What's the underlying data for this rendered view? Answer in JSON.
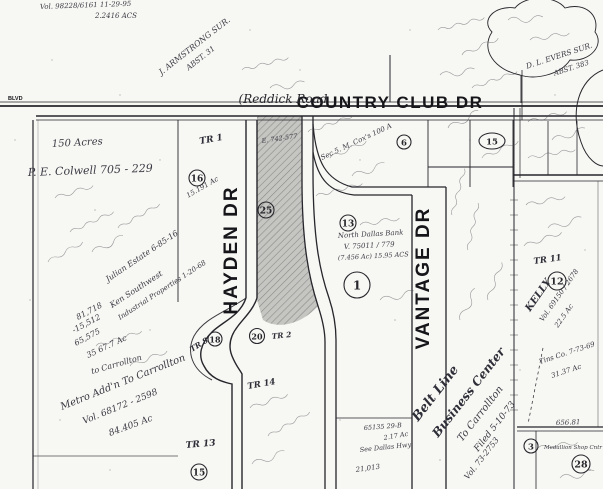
{
  "map": {
    "roads": {
      "blvd": "BLVD",
      "reddick": "(Reddick Road",
      "country_club": "COUNTRY CLUB DR",
      "hayden": "HAYDEN DR",
      "vantage": "VANTAGE DR"
    },
    "surveys": {
      "armstrong1": "J. ARMSTRONG SUR.",
      "armstrong2": "ABST. 31",
      "evers1": "D. L. EVERS SUR.",
      "evers2": "ABST. 383"
    },
    "tracts": {
      "tr1": "TR 1",
      "tr2": "TR 2",
      "tr8": "TR 8",
      "tr11": "TR 11",
      "tr13": "TR 13",
      "tr14": "TR 14"
    },
    "circled": {
      "c16": "16",
      "c25": "25",
      "c13": "13",
      "c1": "1",
      "c6": "6",
      "c15a": "15",
      "c12": "12",
      "c18": "18",
      "c20": "20",
      "c15b": "15",
      "c3": "3",
      "c28": "28"
    },
    "notes": {
      "vol1": "Vol. 98228/6161  11-29-95",
      "vol2": "2.2416 ACS",
      "colwell1": "150 Acres",
      "colwell2": "P. E. Colwell   705 - 229",
      "cox": "Sec 5.  M. Cox's  100 A",
      "shade_ref": "E. 742-577",
      "tr1_ac": "15.191 Ac",
      "julian": "Julian Estate  6-85-16",
      "sw1": "Ken Southwest",
      "sw2": "Industrial Properties  1-20-68",
      "calc1": "81,718",
      "calc2": "-15,512",
      "calc3": "65,575",
      "calc4": "35  67.7 Ac",
      "carrollton": "to Carrollton",
      "metro1": "Metro Add'n To Carrollton",
      "metro2": "Vol. 68172 - 2598",
      "metro3": "84.405 Ac",
      "ndb1": "North Dallas Bank",
      "ndb2": "V. 75011 / 779",
      "ndb3": "(7.456 Ac)   15.95 ACS",
      "belt1": "Belt Line",
      "belt2": "Business Center",
      "belt3": "To Carrollton",
      "belt4": "Filed  5-10-73",
      "belt5": "Vol. 73-2753",
      "kelly1": "KELLY",
      "kelly2": "Vol. 69150 / 2678",
      "kelly3": "22.5 Ac",
      "tins1": "Tins Co.  7-73-69",
      "tins2": "31.37 Ac",
      "dim656": "656.81",
      "medallion": "Medallion Shop Cntr",
      "dallas1": "65135  29-B",
      "dallas2": "2.17 Ac",
      "dallas3": "See Dallas Hwy",
      "sq": "21,013"
    }
  }
}
